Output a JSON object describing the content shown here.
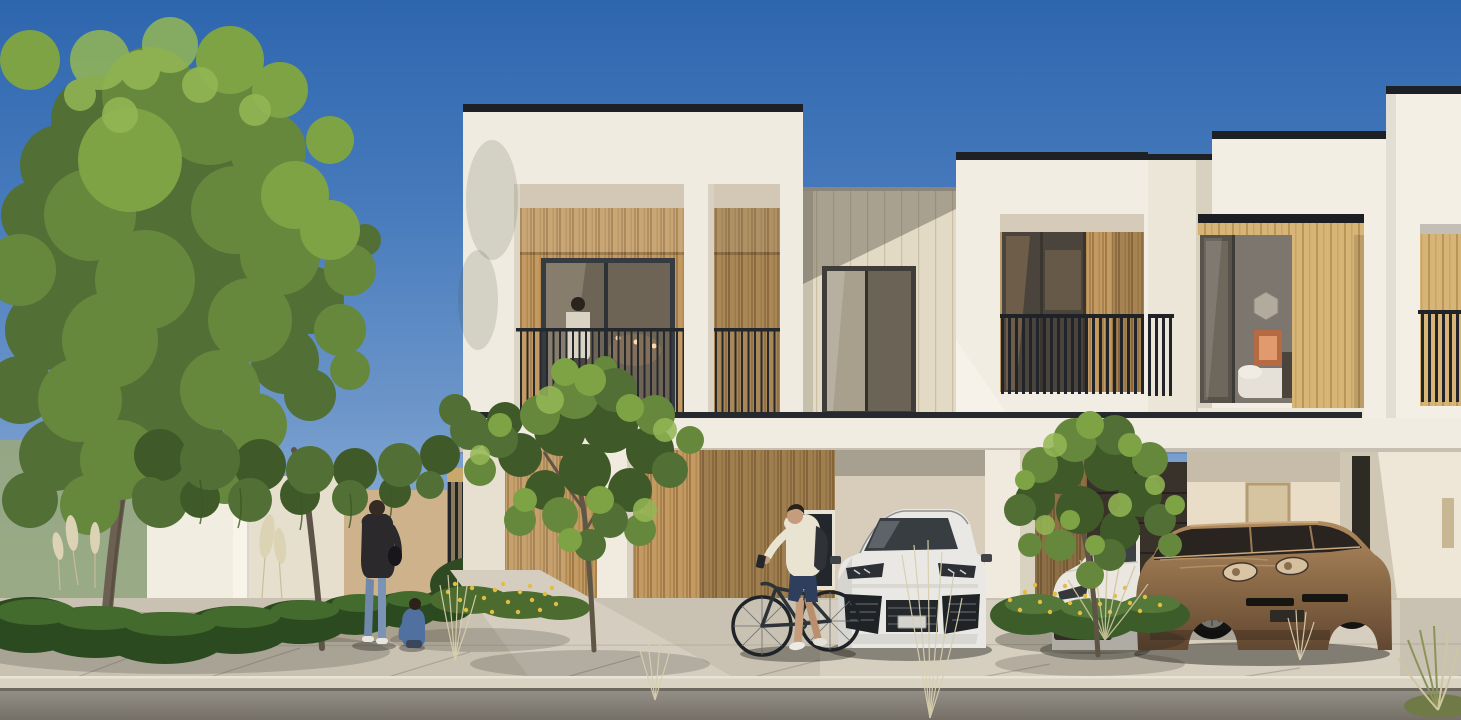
{
  "scene": {
    "caption": "Daytime architectural rendering of a row of modern white townhouses with timber-slat accents, recessed balconies, covered carports, front gardens, pedestrians and a cyclist on the sidewalk.",
    "sky": {
      "condition": "clear blue, lighter toward horizon",
      "top_color": "#2e66ae",
      "horizon_color": "#b3cbe4"
    },
    "palette": {
      "facade_white": "#f0ebe0",
      "facade_shadow": "#d9d2c2",
      "parapet_coping_dark": "#1d2126",
      "timber_mid": "#c29a62",
      "timber_light": "#d6b577",
      "panel_cream": "#e2dac4",
      "railing_dark": "#23262a",
      "sidewalk": "#c9c2b2",
      "road": "#7d7870",
      "foliage_dark": "#3f5a28",
      "foliage_mid": "#66883d",
      "foliage_light": "#94b755",
      "trunk": "#6b6052",
      "flower_yellow": "#e2bd41",
      "pampas_tan": "#dcd2b4",
      "suv_white": "#e9e8e4",
      "sedan_white": "#eae7e1",
      "car_bronze": "#8d6c48",
      "denim_blue": "#7089ab",
      "jacket_dark": "#2b292c",
      "jacket_cream": "#e9e3d1",
      "backpack_dark": "#2f3236"
    },
    "buildings": [
      {
        "id": "unit-1",
        "description": "white cubic two-storey volume, dark parapet coping, double recessed balcony with timber slat wall, glass door with warm pendant lights, thin metal railing, person standing on balcony"
      },
      {
        "id": "link-wall",
        "description": "cream vertically panelled link wall with dark-framed bedroom window, diagonal cast shadow"
      },
      {
        "id": "unit-2",
        "description": "white cubic volume, dark coping, recessed balcony with glass sliding door, timber pillar and tall dark slat balustrade"
      },
      {
        "id": "unit-3",
        "description": "stepped white volumes, timber-framed bay window revealing bedroom with orange artwork and white bed, dark slat balustrades at sides"
      }
    ],
    "ground_floor": {
      "elements": [
        "continuous white carport canopy with dark shadow line",
        "timber slat entrance wall with small dark window",
        "white porch pillar",
        "two covered carports",
        "dark recessed garage door",
        "warm-lit interior wall with door",
        "sunlit end wall with diagonal shadow"
      ]
    },
    "vehicles": [
      {
        "id": "white-suv",
        "type": "luxury SUV, angular headlights and large dark intakes",
        "color": "#e9e8e4",
        "location": "left carport"
      },
      {
        "id": "white-sedan",
        "type": "sedan front, dark oval grille",
        "color": "#eae7e1",
        "location": "right carport, partly hidden by planting"
      },
      {
        "id": "bronze-car",
        "type": "low sports sedan, oval headlights",
        "color": "#8d6c48",
        "location": "right carport"
      }
    ],
    "people": [
      {
        "id": "balcony-person",
        "pose": "standing at balcony railing",
        "location": "unit-1 balcony"
      },
      {
        "id": "woman-walking",
        "pose": "walking away on garden path",
        "clothing": [
          "dark jacket",
          "blue jeans",
          "white shoes",
          "dark shoulder bag"
        ]
      },
      {
        "id": "child-crouching",
        "pose": "crouching at planting bed beside woman",
        "clothing": [
          "blue outfit"
        ]
      },
      {
        "id": "cyclist",
        "pose": "standing astride beside bicycle, looking at phone",
        "clothing": [
          "cream jacket",
          "dark backpack",
          "navy shorts",
          "white sneakers"
        ]
      }
    ],
    "vegetation": {
      "trees": [
        "large leafy tree over left garden",
        "medium tree in front of unit-1",
        "small tree in carport planter"
      ],
      "planting": [
        "clipped dark hedges",
        "ornamental spiky grasses",
        "pampas plumes",
        "yellow flower beds left and right",
        "dry grass tufts on sidewalk and bottom-right corner",
        "foliage overhanging garden walls"
      ]
    },
    "street": {
      "elements": [
        "white garden wall and post",
        "shaded wall section",
        "tan wall",
        "dark slatted garden gate with timber post",
        "stone-paved sidewalk with diagonal joints",
        "light concrete curb",
        "asphalt road strip at bottom"
      ]
    }
  }
}
